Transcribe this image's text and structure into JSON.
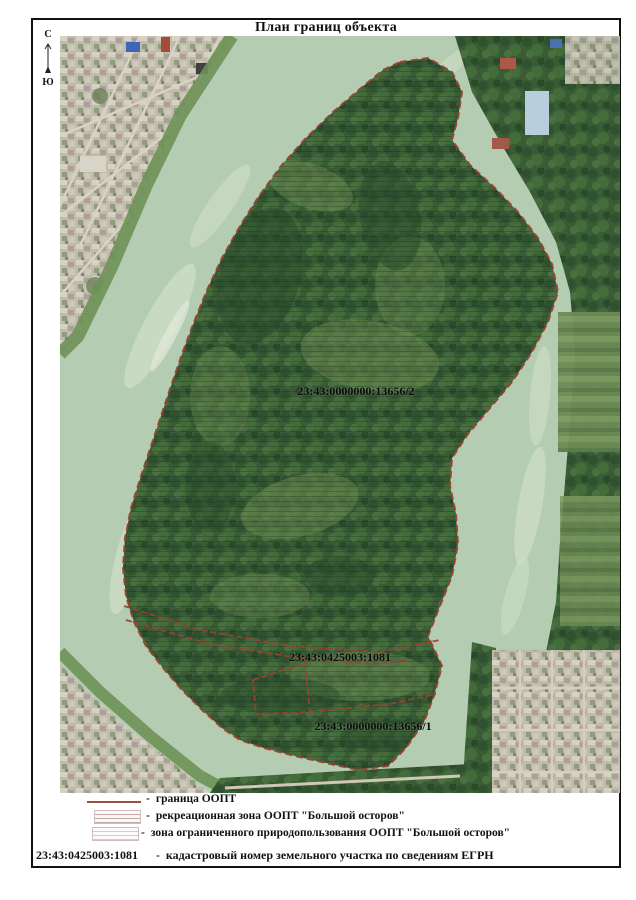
{
  "page": {
    "title": "План границ объекта"
  },
  "compass": {
    "north": "С",
    "south": "Ю"
  },
  "map": {
    "labels": [
      {
        "text": "23:43:0000000:13656/2"
      },
      {
        "text": "23:43:0425003:1081"
      },
      {
        "text": "23:43:0000000:13656/1"
      }
    ]
  },
  "legend": {
    "items": [
      {
        "dash": "-",
        "label": "граница ООПТ"
      },
      {
        "dash": "-",
        "label": "рекреационная зона ООПТ \"Большой осторов\""
      },
      {
        "dash": "-",
        "label": "зона ограниченного природопользования ООПТ \"Большой осторов\""
      },
      {
        "dash": "-",
        "number": "23:43:0425003:1081",
        "label": "кадастровый номер земельного участка по сведениям ЕГРН"
      }
    ]
  },
  "colors": {
    "boundary": "#9c4030",
    "water": "#b4cdb2",
    "forest": "#3a5c35"
  }
}
